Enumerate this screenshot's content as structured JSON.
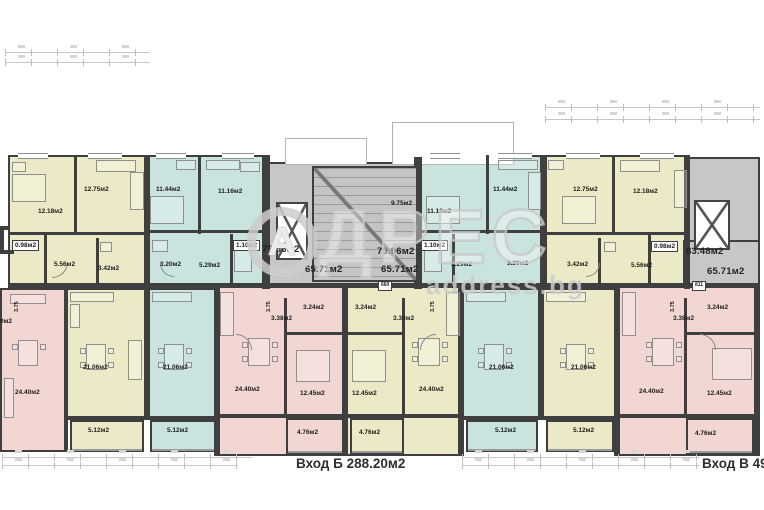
{
  "palette": {
    "yellow": "#eceac6",
    "blue": "#c9e3df",
    "pink": "#f2d6d2",
    "gray": "#c7c7c7",
    "wall": "#3f3f3f",
    "label": "#1c1c1c",
    "watermark": "#cdcdcd"
  },
  "watermark": {
    "logo_letter": "А",
    "brand_rest": "ДРЕС",
    "site": "address.bg"
  },
  "footer": {
    "entrance_b": "Вход Б 288.20м2",
    "entrance_v": "Вход В 493"
  },
  "plan": {
    "rooms": [
      [
        8,
        155,
        140,
        135,
        "yellow"
      ],
      [
        148,
        155,
        117,
        135,
        "blue"
      ],
      [
        420,
        155,
        125,
        135,
        "blue"
      ],
      [
        545,
        155,
        145,
        135,
        "yellow"
      ],
      [
        268,
        162,
        152,
        126,
        "gray"
      ],
      [
        688,
        157,
        72,
        131,
        "gray"
      ],
      [
        683,
        240,
        77,
        50,
        "gray"
      ],
      [
        0,
        288,
        66,
        164,
        "pink"
      ],
      [
        66,
        288,
        82,
        132,
        "yellow"
      ],
      [
        70,
        420,
        74,
        32,
        "yellow"
      ],
      [
        148,
        288,
        70,
        132,
        "blue"
      ],
      [
        150,
        420,
        66,
        32,
        "blue"
      ],
      [
        218,
        284,
        128,
        172,
        "pink"
      ],
      [
        286,
        418,
        58,
        36,
        "pink"
      ],
      [
        346,
        284,
        116,
        172,
        "yellow"
      ],
      [
        350,
        418,
        54,
        36,
        "yellow"
      ],
      [
        462,
        288,
        80,
        132,
        "blue"
      ],
      [
        466,
        420,
        72,
        32,
        "blue"
      ],
      [
        542,
        288,
        76,
        132,
        "yellow"
      ],
      [
        546,
        420,
        68,
        32,
        "yellow"
      ],
      [
        618,
        284,
        142,
        172,
        "pink"
      ],
      [
        686,
        418,
        68,
        36,
        "pink"
      ]
    ],
    "walls": [
      [
        8,
        283,
        752,
        5
      ],
      [
        144,
        155,
        6,
        134
      ],
      [
        262,
        155,
        8,
        134
      ],
      [
        414,
        157,
        8,
        132
      ],
      [
        540,
        155,
        7,
        134
      ],
      [
        684,
        157,
        6,
        132
      ],
      [
        64,
        288,
        4,
        164
      ],
      [
        144,
        288,
        4,
        132
      ],
      [
        214,
        284,
        6,
        172
      ],
      [
        342,
        284,
        6,
        172
      ],
      [
        458,
        284,
        6,
        172
      ],
      [
        538,
        288,
        4,
        132
      ],
      [
        614,
        284,
        6,
        172
      ],
      [
        754,
        284,
        6,
        172
      ],
      [
        74,
        155,
        3,
        80
      ],
      [
        8,
        232,
        140,
        3
      ],
      [
        44,
        232,
        3,
        56
      ],
      [
        96,
        238,
        3,
        50
      ],
      [
        198,
        155,
        3,
        79
      ],
      [
        148,
        230,
        116,
        3
      ],
      [
        230,
        234,
        3,
        52
      ],
      [
        486,
        155,
        3,
        79
      ],
      [
        420,
        230,
        120,
        3
      ],
      [
        452,
        234,
        3,
        52
      ],
      [
        612,
        155,
        3,
        80
      ],
      [
        545,
        232,
        143,
        3
      ],
      [
        648,
        232,
        3,
        56
      ],
      [
        598,
        238,
        3,
        50
      ],
      [
        284,
        298,
        3,
        120
      ],
      [
        284,
        332,
        60,
        3
      ],
      [
        402,
        298,
        3,
        120
      ],
      [
        346,
        332,
        58,
        3
      ],
      [
        684,
        298,
        3,
        120
      ],
      [
        684,
        332,
        72,
        3
      ],
      [
        66,
        416,
        82,
        4
      ],
      [
        148,
        416,
        70,
        4
      ],
      [
        462,
        416,
        80,
        4
      ],
      [
        542,
        416,
        76,
        4
      ],
      [
        218,
        414,
        128,
        4
      ],
      [
        346,
        414,
        116,
        4
      ],
      [
        618,
        414,
        142,
        4
      ],
      [
        0,
        226,
        10,
        4
      ],
      [
        0,
        250,
        14,
        4
      ],
      [
        0,
        226,
        4,
        28
      ]
    ],
    "windows": [
      [
        18,
        153,
        30,
        6
      ],
      [
        88,
        153,
        34,
        6
      ],
      [
        156,
        153,
        30,
        6
      ],
      [
        222,
        153,
        32,
        6
      ],
      [
        430,
        153,
        30,
        6
      ],
      [
        498,
        153,
        34,
        6
      ],
      [
        566,
        153,
        34,
        6
      ],
      [
        640,
        153,
        34,
        6
      ]
    ],
    "rails": [
      [
        72,
        449,
        70,
        2
      ],
      [
        152,
        449,
        62,
        2
      ],
      [
        288,
        451,
        54,
        2
      ],
      [
        352,
        451,
        50,
        2
      ],
      [
        468,
        449,
        68,
        2
      ],
      [
        548,
        449,
        64,
        2
      ],
      [
        688,
        451,
        64,
        2
      ]
    ],
    "ghosts": [
      [
        285,
        138,
        80,
        25
      ],
      [
        392,
        122,
        120,
        41
      ]
    ],
    "elevators": [
      [
        276,
        202,
        32,
        58
      ],
      [
        694,
        200,
        36,
        50
      ]
    ],
    "stairs": [
      312,
      166,
      106,
      116
    ],
    "arcs": [
      [
        52,
        262,
        16,
        "br"
      ],
      [
        160,
        263,
        14,
        "bl"
      ],
      [
        236,
        334,
        16,
        "tr"
      ],
      [
        420,
        334,
        16,
        "tl"
      ],
      [
        586,
        263,
        14,
        "br"
      ],
      [
        700,
        334,
        16,
        "tr"
      ]
    ],
    "dims": [
      [
        5,
        52,
        145,
        1
      ],
      [
        5,
        62,
        145,
        1
      ],
      [
        545,
        107,
        215,
        1
      ],
      [
        545,
        119,
        215,
        1
      ],
      [
        2,
        457,
        250,
        1
      ],
      [
        2,
        465,
        236,
        1
      ],
      [
        462,
        457,
        238,
        1
      ],
      [
        462,
        465,
        238,
        1
      ]
    ],
    "furniture": [
      [
        12,
        174,
        34,
        28
      ],
      [
        12,
        162,
        14,
        10
      ],
      [
        96,
        160,
        40,
        12
      ],
      [
        130,
        172,
        14,
        38
      ],
      [
        150,
        196,
        34,
        28
      ],
      [
        176,
        160,
        20,
        10
      ],
      [
        206,
        160,
        34,
        10
      ],
      [
        240,
        162,
        20,
        10
      ],
      [
        100,
        242,
        12,
        10
      ],
      [
        152,
        240,
        16,
        12
      ],
      [
        234,
        246,
        18,
        26
      ],
      [
        426,
        196,
        34,
        28
      ],
      [
        498,
        160,
        40,
        10
      ],
      [
        528,
        172,
        13,
        38
      ],
      [
        424,
        246,
        18,
        26
      ],
      [
        562,
        196,
        34,
        28
      ],
      [
        548,
        160,
        16,
        10
      ],
      [
        620,
        160,
        40,
        12
      ],
      [
        674,
        170,
        13,
        38
      ],
      [
        604,
        242,
        12,
        10
      ],
      [
        70,
        292,
        44,
        10
      ],
      [
        70,
        304,
        10,
        24
      ],
      [
        86,
        344,
        20,
        26
      ],
      [
        80,
        348,
        6,
        6
      ],
      [
        108,
        348,
        6,
        6
      ],
      [
        80,
        362,
        6,
        6
      ],
      [
        108,
        362,
        6,
        6
      ],
      [
        128,
        340,
        14,
        40
      ],
      [
        152,
        292,
        40,
        10
      ],
      [
        164,
        344,
        20,
        26
      ],
      [
        158,
        348,
        6,
        6
      ],
      [
        186,
        348,
        6,
        6
      ],
      [
        158,
        362,
        6,
        6
      ],
      [
        186,
        362,
        6,
        6
      ],
      [
        220,
        292,
        14,
        44
      ],
      [
        248,
        338,
        22,
        28
      ],
      [
        242,
        342,
        6,
        6
      ],
      [
        272,
        342,
        6,
        6
      ],
      [
        242,
        356,
        6,
        6
      ],
      [
        272,
        356,
        6,
        6
      ],
      [
        296,
        350,
        34,
        32
      ],
      [
        446,
        292,
        14,
        44
      ],
      [
        418,
        338,
        22,
        28
      ],
      [
        412,
        342,
        6,
        6
      ],
      [
        442,
        342,
        6,
        6
      ],
      [
        412,
        356,
        6,
        6
      ],
      [
        442,
        356,
        6,
        6
      ],
      [
        352,
        350,
        34,
        32
      ],
      [
        466,
        292,
        40,
        10
      ],
      [
        484,
        344,
        20,
        26
      ],
      [
        478,
        348,
        6,
        6
      ],
      [
        506,
        348,
        6,
        6
      ],
      [
        478,
        362,
        6,
        6
      ],
      [
        506,
        362,
        6,
        6
      ],
      [
        546,
        292,
        40,
        10
      ],
      [
        566,
        344,
        20,
        26
      ],
      [
        560,
        348,
        6,
        6
      ],
      [
        588,
        348,
        6,
        6
      ],
      [
        560,
        362,
        6,
        6
      ],
      [
        588,
        362,
        6,
        6
      ],
      [
        622,
        292,
        14,
        44
      ],
      [
        652,
        338,
        22,
        28
      ],
      [
        646,
        342,
        6,
        6
      ],
      [
        676,
        342,
        6,
        6
      ],
      [
        646,
        356,
        6,
        6
      ],
      [
        676,
        356,
        6,
        6
      ],
      [
        712,
        348,
        40,
        32
      ],
      [
        10,
        294,
        36,
        10
      ],
      [
        18,
        340,
        20,
        26
      ],
      [
        12,
        344,
        6,
        6
      ],
      [
        40,
        344,
        6,
        6
      ],
      [
        4,
        378,
        10,
        40
      ]
    ],
    "labels": [
      {
        "t": "12.18м2",
        "x": 38,
        "y": 208
      },
      {
        "t": "12.75м2",
        "x": 84,
        "y": 186
      },
      {
        "t": "0.98м2",
        "x": 12,
        "y": 240,
        "k": "box"
      },
      {
        "t": "5.56м2",
        "x": 54,
        "y": 261
      },
      {
        "t": "3.42м2",
        "x": 98,
        "y": 265
      },
      {
        "t": "11.44м2",
        "x": 156,
        "y": 186
      },
      {
        "t": "11.16м2",
        "x": 218,
        "y": 188
      },
      {
        "t": "1.10м2",
        "x": 233,
        "y": 240,
        "k": "box"
      },
      {
        "t": "3.20м2",
        "x": 160,
        "y": 261
      },
      {
        "t": "5.29м2",
        "x": 199,
        "y": 262
      },
      {
        "t": "9.75м2",
        "x": 391,
        "y": 200
      },
      {
        "t": "11.16м2",
        "x": 427,
        "y": 208
      },
      {
        "t": "11.44м2",
        "x": 493,
        "y": 186
      },
      {
        "t": "1.10м2",
        "x": 421,
        "y": 240,
        "k": "box"
      },
      {
        "t": "5.29м2",
        "x": 451,
        "y": 261
      },
      {
        "t": "3.20м2",
        "x": 507,
        "y": 260
      },
      {
        "t": "12.75м2",
        "x": 573,
        "y": 186
      },
      {
        "t": "12.18м2",
        "x": 633,
        "y": 188
      },
      {
        "t": "0.98м2",
        "x": 651,
        "y": 241,
        "k": "box"
      },
      {
        "t": "3.42м2",
        "x": 567,
        "y": 261
      },
      {
        "t": "5.56м2",
        "x": 631,
        "y": 262
      },
      {
        "t": "79.96м2",
        "x": 262,
        "y": 245,
        "k": "big"
      },
      {
        "t": "79.96м2",
        "x": 377,
        "y": 247,
        "k": "big"
      },
      {
        "t": "65.71м2",
        "x": 305,
        "y": 265,
        "k": "big"
      },
      {
        "t": "65.71м2",
        "x": 381,
        "y": 265,
        "k": "big"
      },
      {
        "t": "83.48м2",
        "x": 686,
        "y": 247,
        "k": "big"
      },
      {
        "t": "65.71м2",
        "x": 707,
        "y": 267,
        "k": "big"
      },
      {
        "t": "660",
        "x": 378,
        "y": 281,
        "k": "box",
        "s": 5
      },
      {
        "t": "811",
        "x": 692,
        "y": 281,
        "k": "box",
        "s": 5
      },
      {
        "t": "24.40м2",
        "x": 15,
        "y": 389
      },
      {
        "t": "21.06м2",
        "x": 83,
        "y": 364
      },
      {
        "t": "5.12м2",
        "x": 88,
        "y": 427
      },
      {
        "t": "21.06м2",
        "x": 163,
        "y": 364
      },
      {
        "t": "5.12м2",
        "x": 167,
        "y": 427
      },
      {
        "t": "3.24м2",
        "x": 303,
        "y": 304
      },
      {
        "t": "3.38м2",
        "x": 271,
        "y": 315
      },
      {
        "t": "24.40м2",
        "x": 235,
        "y": 386
      },
      {
        "t": "12.45м2",
        "x": 300,
        "y": 390
      },
      {
        "t": "4.76м2",
        "x": 297,
        "y": 429
      },
      {
        "t": "3.24м2",
        "x": 355,
        "y": 304
      },
      {
        "t": "3.38м2",
        "x": 393,
        "y": 315
      },
      {
        "t": "12.45м2",
        "x": 352,
        "y": 390
      },
      {
        "t": "24.40м2",
        "x": 419,
        "y": 386
      },
      {
        "t": "4.76м2",
        "x": 359,
        "y": 429
      },
      {
        "t": "21.06м2",
        "x": 489,
        "y": 364
      },
      {
        "t": "5.12м2",
        "x": 495,
        "y": 427
      },
      {
        "t": "21.06м2",
        "x": 571,
        "y": 364
      },
      {
        "t": "5.12м2",
        "x": 573,
        "y": 427
      },
      {
        "t": "3.24м2",
        "x": 707,
        "y": 304
      },
      {
        "t": "3.38м2",
        "x": 673,
        "y": 315
      },
      {
        "t": "24.40м2",
        "x": 639,
        "y": 388
      },
      {
        "t": "12.45м2",
        "x": 707,
        "y": 390
      },
      {
        "t": "4.76м2",
        "x": 695,
        "y": 430
      },
      {
        "t": "3.75",
        "x": 14,
        "y": 312,
        "k": "rot"
      },
      {
        "t": "3.75",
        "x": 266,
        "y": 312,
        "k": "rot"
      },
      {
        "t": "3.75",
        "x": 430,
        "y": 312,
        "k": "rot"
      },
      {
        "t": "3.75",
        "x": 670,
        "y": 312,
        "k": "rot"
      },
      {
        "t": "0м2",
        "x": 0,
        "y": 318
      }
    ]
  }
}
